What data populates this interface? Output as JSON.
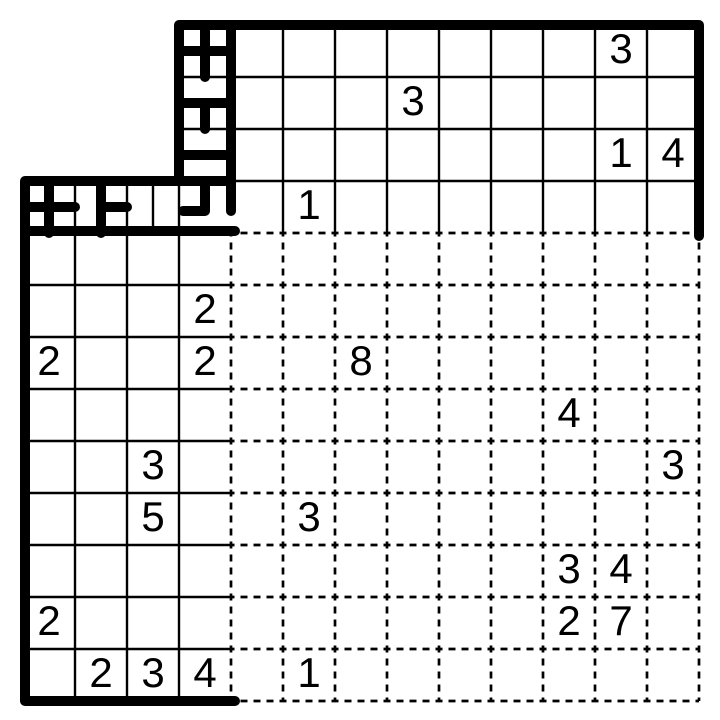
{
  "board": {
    "rows": 13,
    "cols": 13,
    "cell_px": 52,
    "origin": {
      "x": 23,
      "y": 25
    },
    "cutout": {
      "corner": "top-left",
      "rows": 3,
      "cols": 3
    },
    "colors": {
      "ink": "#000000",
      "background": "#ffffff"
    },
    "line_styles": {
      "thick_px": 10,
      "thin_px": 2.4,
      "dash_px": 2.7,
      "dash_array": "7 6",
      "dash_offset": 3.5
    }
  },
  "clues": [
    {
      "row": 0,
      "col": 11,
      "value": "3"
    },
    {
      "row": 1,
      "col": 7,
      "value": "3"
    },
    {
      "row": 2,
      "col": 11,
      "value": "1"
    },
    {
      "row": 2,
      "col": 12,
      "value": "4"
    },
    {
      "row": 3,
      "col": 5,
      "value": "1"
    },
    {
      "row": 5,
      "col": 3,
      "value": "2"
    },
    {
      "row": 6,
      "col": 0,
      "value": "2"
    },
    {
      "row": 6,
      "col": 3,
      "value": "2"
    },
    {
      "row": 6,
      "col": 6,
      "value": "8"
    },
    {
      "row": 7,
      "col": 10,
      "value": "4"
    },
    {
      "row": 8,
      "col": 2,
      "value": "3"
    },
    {
      "row": 8,
      "col": 12,
      "value": "3"
    },
    {
      "row": 9,
      "col": 2,
      "value": "5"
    },
    {
      "row": 9,
      "col": 5,
      "value": "3"
    },
    {
      "row": 10,
      "col": 10,
      "value": "3"
    },
    {
      "row": 10,
      "col": 11,
      "value": "4"
    },
    {
      "row": 11,
      "col": 0,
      "value": "2"
    },
    {
      "row": 11,
      "col": 10,
      "value": "2"
    },
    {
      "row": 11,
      "col": 11,
      "value": "7"
    },
    {
      "row": 12,
      "col": 1,
      "value": "2"
    },
    {
      "row": 12,
      "col": 2,
      "value": "3"
    },
    {
      "row": 12,
      "col": 3,
      "value": "4"
    },
    {
      "row": 12,
      "col": 5,
      "value": "1"
    }
  ],
  "drawn_walls": {
    "outline_path": [
      [
        699,
        236
      ],
      [
        699,
        25
      ],
      [
        179,
        25
      ],
      [
        179,
        181
      ],
      [
        25,
        181
      ],
      [
        25,
        701
      ],
      [
        235,
        701
      ]
    ],
    "thick_segments": [
      [
        205,
        25,
        205,
        77
      ],
      [
        179,
        51,
        231,
        51
      ],
      [
        179,
        103,
        231,
        103
      ],
      [
        205,
        103,
        205,
        129
      ],
      [
        179,
        155,
        231,
        155
      ],
      [
        179,
        181,
        231,
        181
      ],
      [
        231,
        25,
        231,
        211
      ],
      [
        49,
        181,
        49,
        233
      ],
      [
        101,
        181,
        101,
        233
      ],
      [
        25,
        207,
        75,
        207
      ],
      [
        101,
        207,
        127,
        207
      ],
      [
        25,
        231,
        235,
        231
      ]
    ],
    "corner_piece": [
      [
        205,
        183
      ],
      [
        205,
        211
      ],
      [
        183,
        211
      ]
    ]
  },
  "solid_grid": {
    "top_region": {
      "x1": 179,
      "y1": 25,
      "x2": 699,
      "y2": 233,
      "v_lines": [
        283,
        335,
        387,
        439,
        491,
        543,
        595,
        647
      ],
      "h_lines": [
        77,
        129,
        181
      ]
    },
    "left_region": {
      "x1": 23,
      "y1": 181,
      "x2": 231,
      "y2": 701,
      "v_lines": [
        75,
        127,
        179
      ],
      "h_lines": [
        285,
        337,
        389,
        441,
        493,
        545,
        597,
        649
      ]
    },
    "extra_thin_segments": [
      [
        153,
        181,
        153,
        233
      ]
    ]
  },
  "dashed_grid": {
    "x1": 231,
    "y1": 233,
    "x2": 699,
    "y2": 701,
    "step": 52
  }
}
